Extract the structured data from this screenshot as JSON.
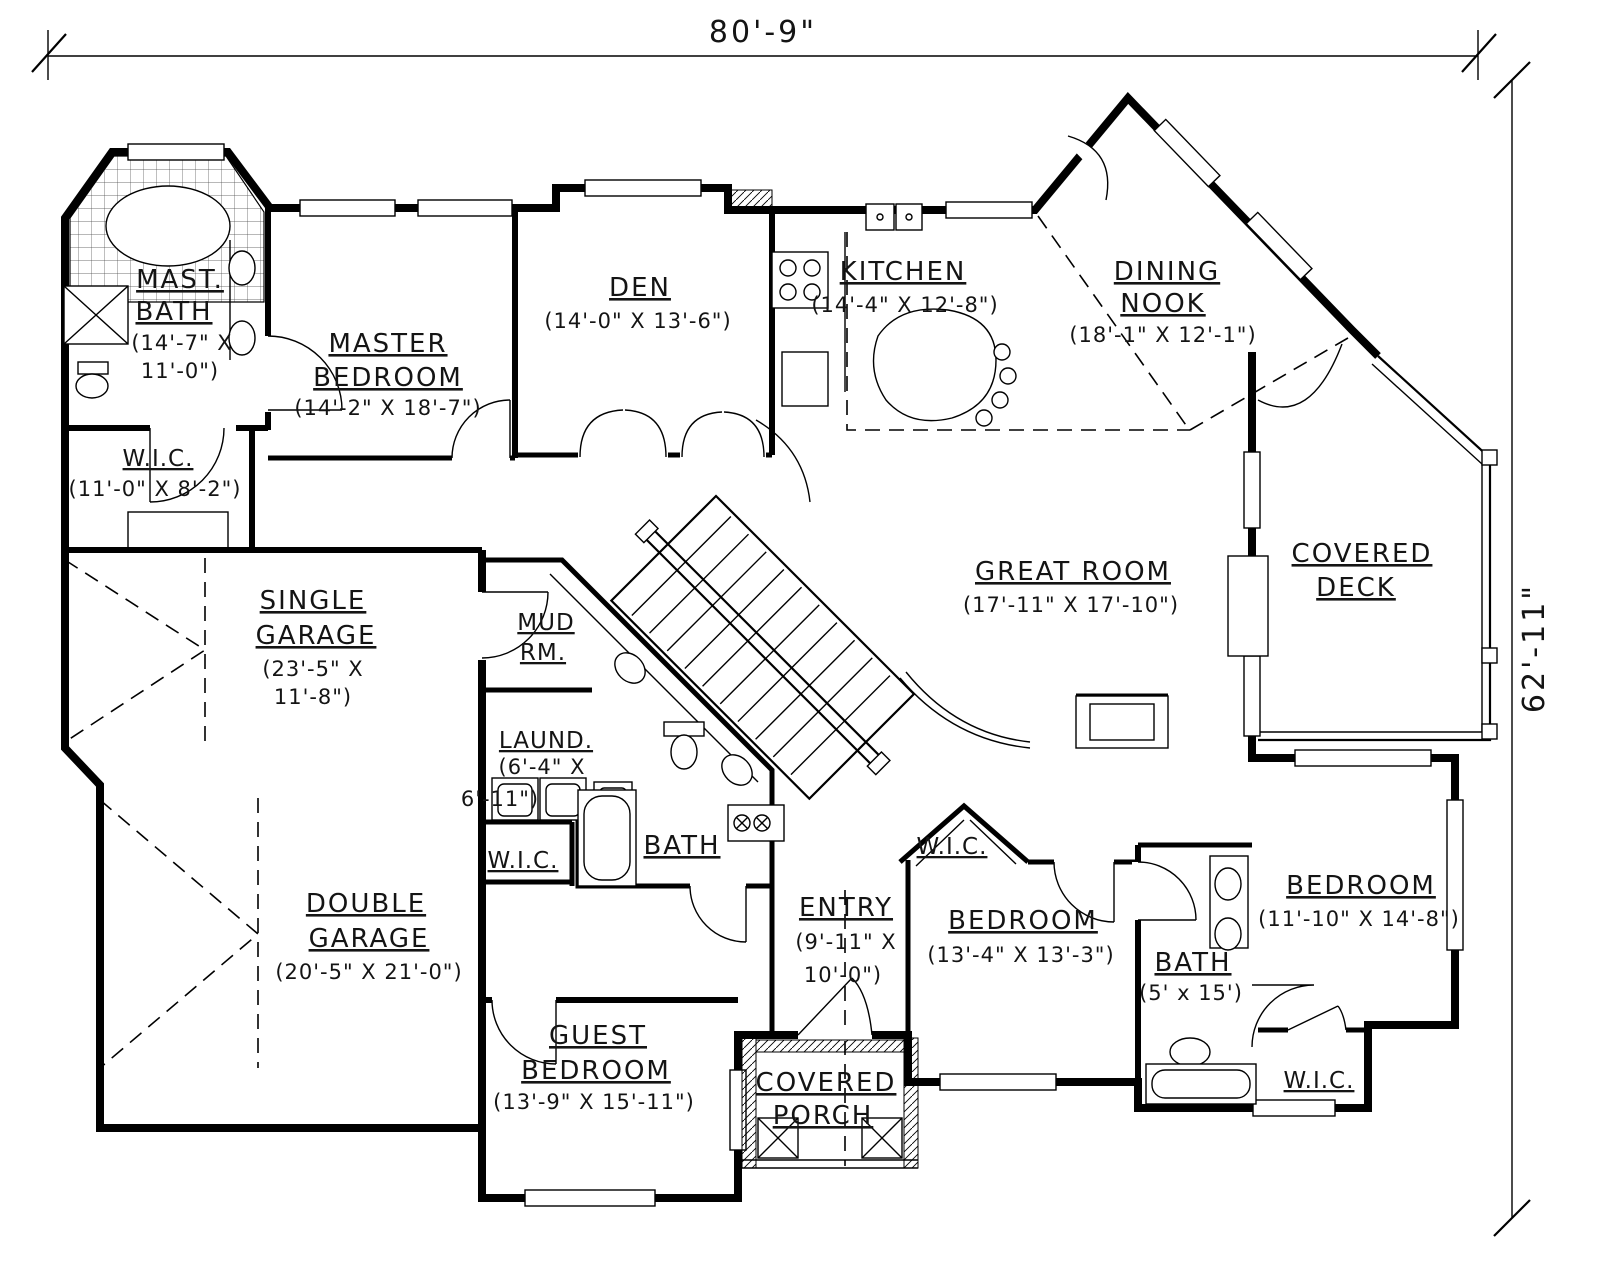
{
  "drawing": {
    "type": "floor-plan",
    "line_color": "#000000",
    "background": "#ffffff"
  },
  "dimensions": {
    "overall_width": "80'-9\"",
    "overall_height": "62'-11\""
  },
  "rooms": {
    "mast_bath": {
      "n1": "MAST.",
      "n2": "BATH",
      "d1": "(14'-7\" X",
      "d2": "11'-0\")"
    },
    "master_bedroom": {
      "n1": "MASTER",
      "n2": "BEDROOM",
      "d1": "(14'-2\" X 18'-7\")"
    },
    "wic_master": {
      "n1": "W.I.C.",
      "d1": "(11'-0\" X 8'-2\")"
    },
    "den": {
      "n1": "DEN",
      "d1": "(14'-0\" X 13'-6\")"
    },
    "kitchen": {
      "n1": "KITCHEN",
      "d1": "(14'-4\" X 12'-8\")"
    },
    "dining_nook": {
      "n1": "DINING",
      "n2": "NOOK",
      "d1": "(18'-1\" X 12'-1\")"
    },
    "great_room": {
      "n1": "GREAT ROOM",
      "d1": "(17'-11\" X 17'-10\")"
    },
    "covered_deck": {
      "n1": "COVERED",
      "n2": "DECK"
    },
    "single_garage": {
      "n1": "SINGLE",
      "n2": "GARAGE",
      "d1": "(23'-5\" X",
      "d2": "11'-8\")"
    },
    "mud_room": {
      "n1": "MUD",
      "n2": "RM."
    },
    "laundry": {
      "n1": "LAUND.",
      "d1": "(6'-4\" X",
      "d2": "6'-11\")"
    },
    "bath_hall": {
      "n1": "BATH"
    },
    "wic_guest": {
      "n1": "W.I.C."
    },
    "double_garage": {
      "n1": "DOUBLE",
      "n2": "GARAGE",
      "d1": "(20'-5\" X 21'-0\")"
    },
    "guest_bedroom": {
      "n1": "GUEST",
      "n2": "BEDROOM",
      "d1": "(13'-9\" X 15'-11\")"
    },
    "entry": {
      "n1": "ENTRY",
      "d1": "(9'-11\" X",
      "d2": "10'-0\")"
    },
    "covered_porch": {
      "n1": "COVERED",
      "n2": "PORCH"
    },
    "bedroom2": {
      "n1": "BEDROOM",
      "d1": "(13'-4\" X 13'-3\")"
    },
    "bath2": {
      "n1": "BATH",
      "d1": "(5' x 15')"
    },
    "wic_bedroom2": {
      "n1": "W.I.C."
    },
    "bedroom3": {
      "n1": "BEDROOM",
      "d1": "(11'-10\" X 14'-8\")"
    },
    "wic_bedroom3": {
      "n1": "W.I.C."
    }
  }
}
